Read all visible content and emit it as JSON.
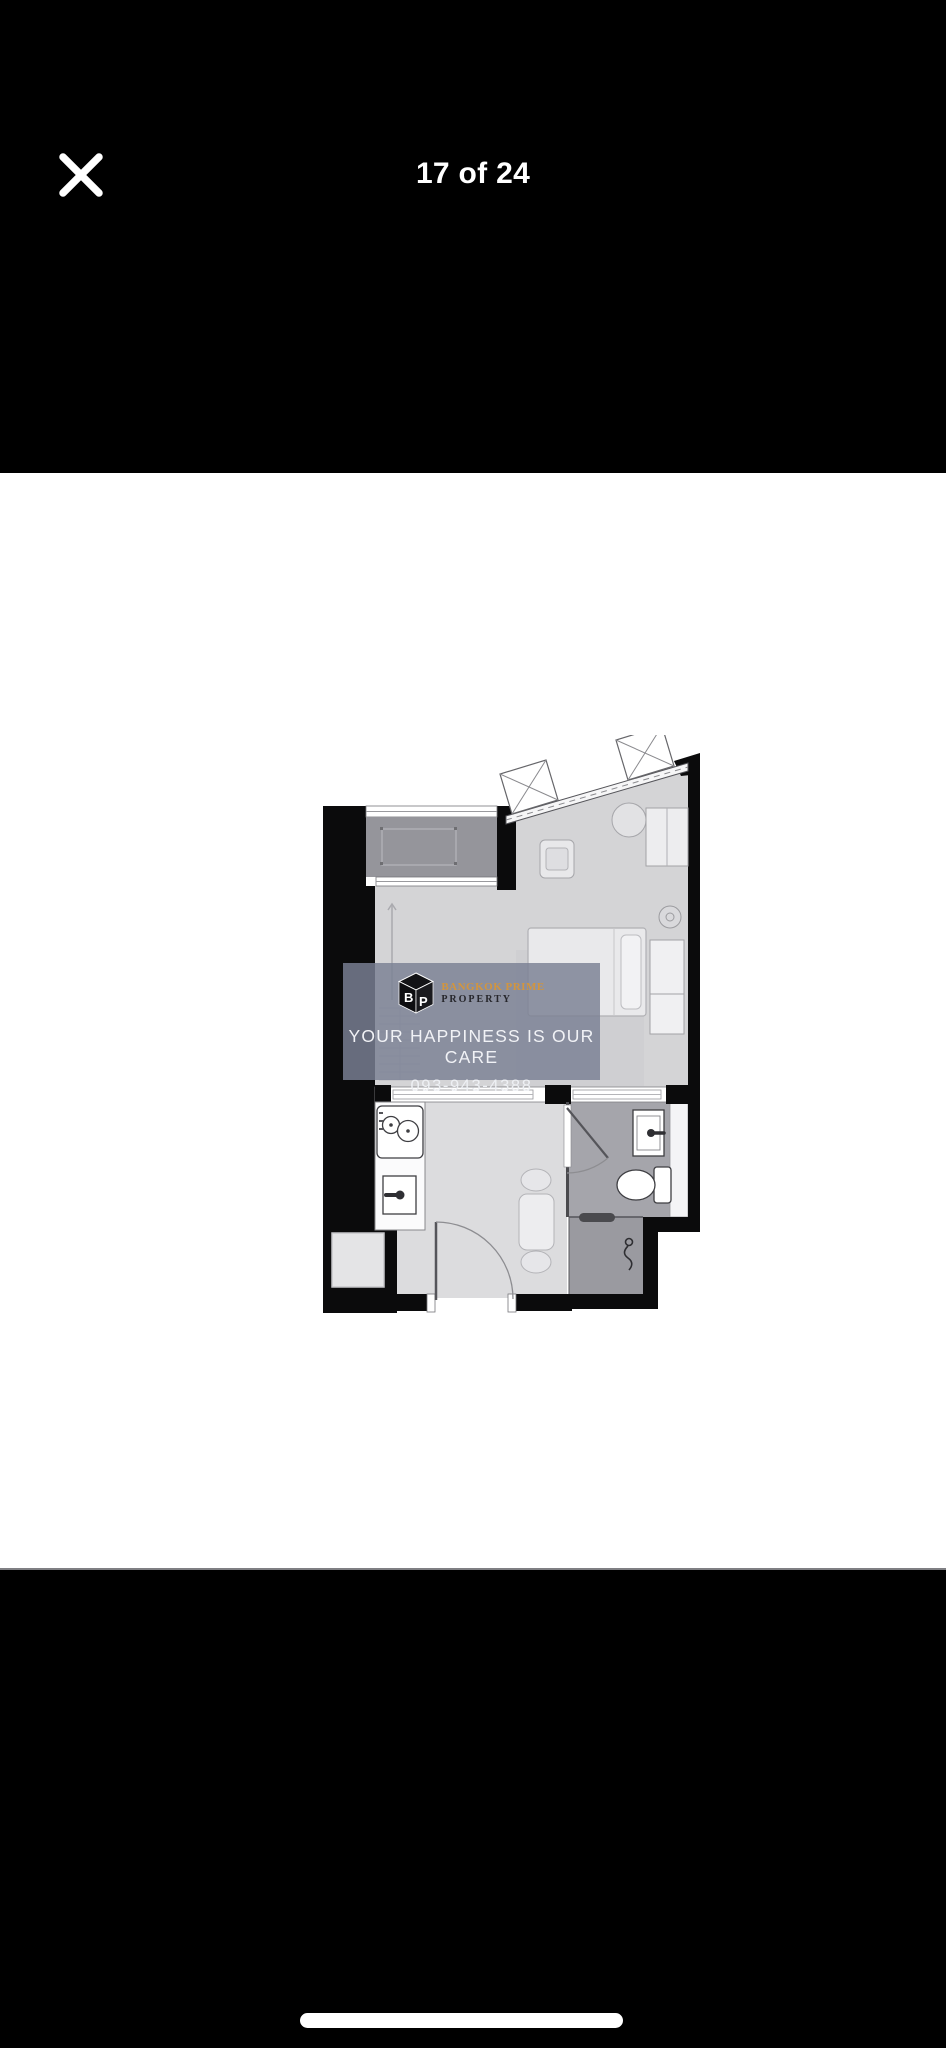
{
  "viewer": {
    "counter": "17 of 24"
  },
  "watermark": {
    "logo_b": "B",
    "logo_p": "P",
    "brand_name": "BANGKOK PRIME",
    "brand_suffix": "PROPERTY",
    "tagline": "YOUR HAPPINESS IS OUR CARE",
    "phone": "093-943-4388"
  },
  "colors": {
    "background": "#000000",
    "photo_background": "#ffffff",
    "brand_orange": "#d2953e",
    "watermark_background": "rgba(123,129,148,0.83)",
    "wall_black": "#0b0b0c",
    "floor_gray": "#d4d4d6",
    "balcony_gray": "#95959b",
    "bathroom_gray": "#a5a5ab",
    "shower_gray": "#9a9aa0"
  }
}
